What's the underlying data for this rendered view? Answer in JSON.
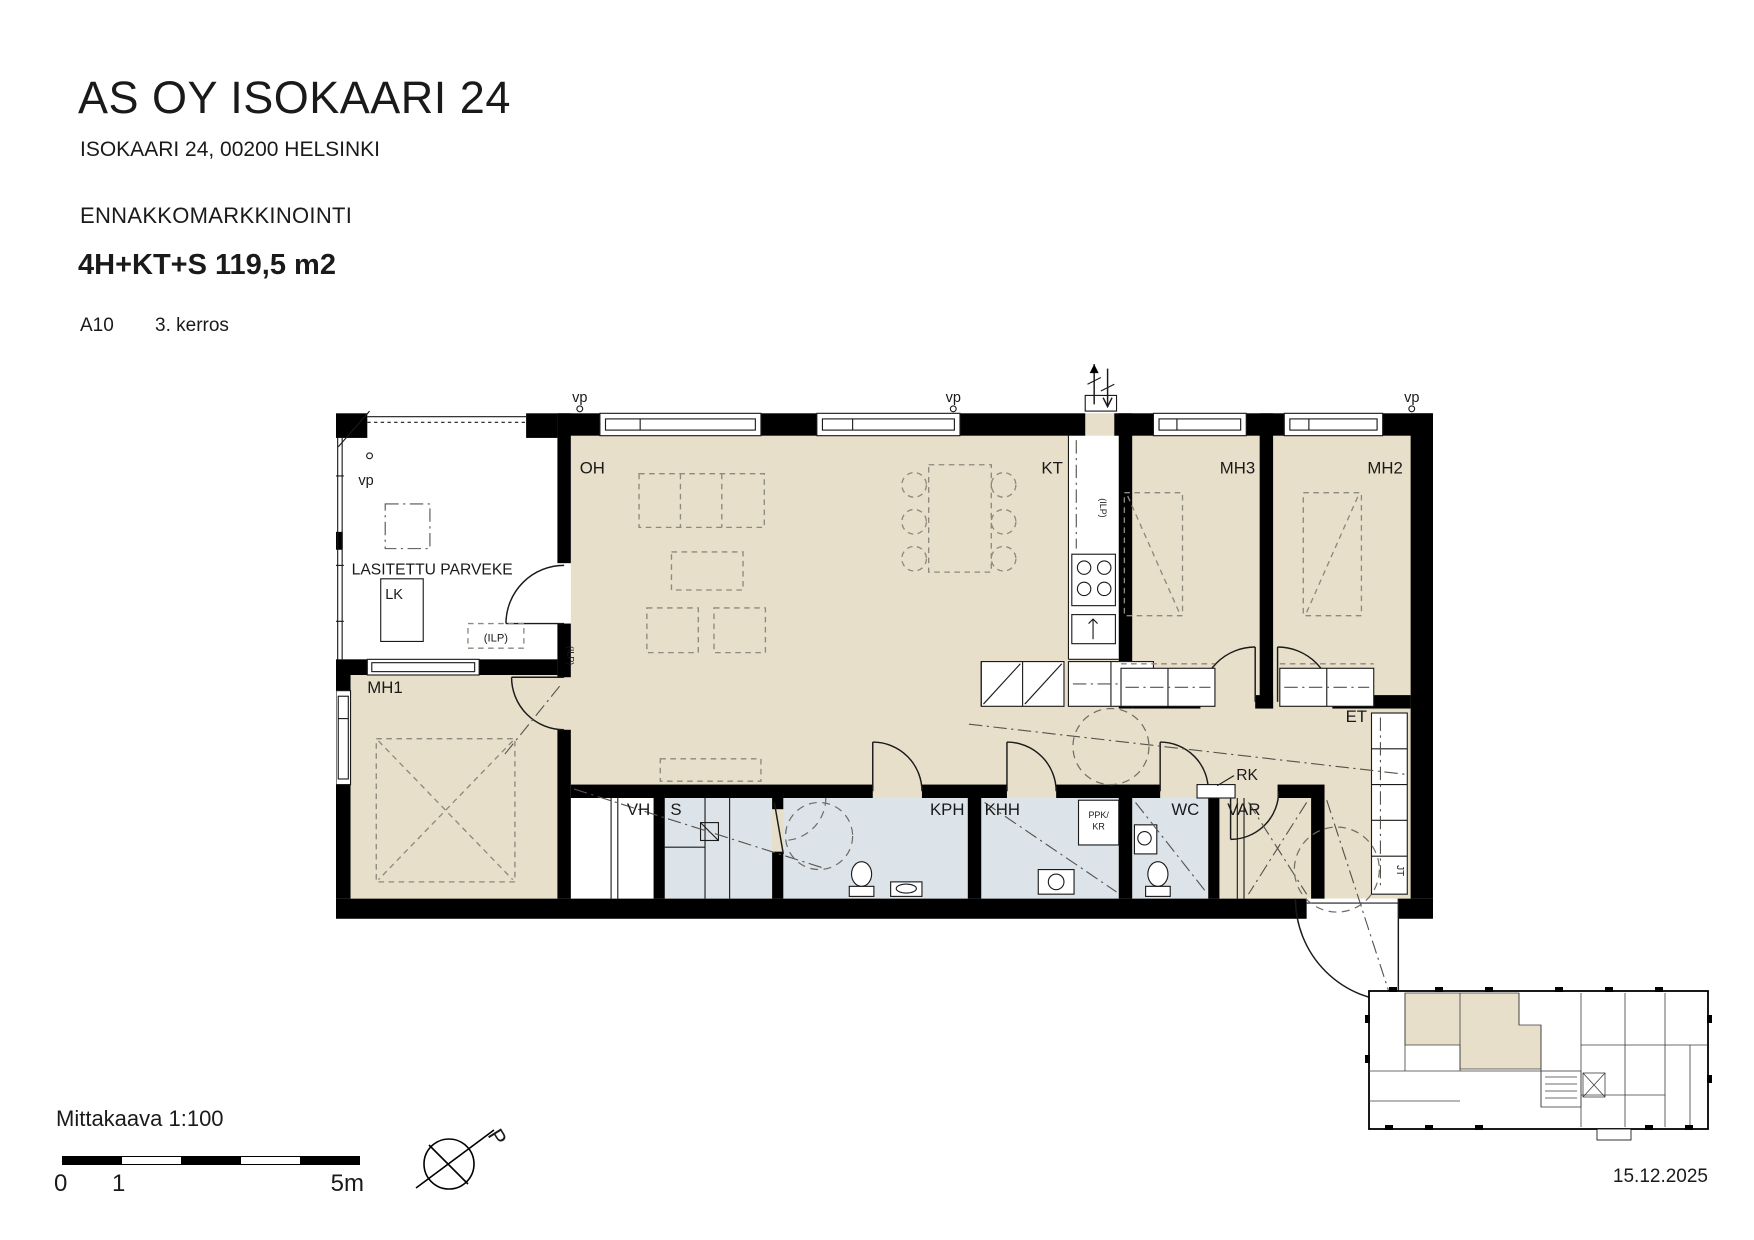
{
  "header": {
    "title": "AS OY ISOKAARI 24",
    "address": "ISOKAARI 24, 00200 HELSINKI",
    "status": "ENNAKKOMARKKINOINTI",
    "unit_type": "4H+KT+S 119,5 m2",
    "unit_id": "A10",
    "floor": "3. kerros"
  },
  "plan": {
    "labels": {
      "balcony": "LASITETTU PARVEKE",
      "lk": "LK",
      "ilp": "(ILP)",
      "vp": "vp",
      "oh": "OH",
      "kt": "KT",
      "mh1": "MH1",
      "mh2": "MH2",
      "mh3": "MH3",
      "vh": "VH",
      "s": "S",
      "kph": "KPH",
      "khh": "KHH",
      "wc": "WC",
      "var": "VAR",
      "et": "ET",
      "rk": "RK",
      "jt": "JT",
      "ppk": "PPK/",
      "kr": "KR"
    },
    "colors": {
      "floor": "#e7dfca",
      "wet": "#dde4e9",
      "wall": "#000000"
    }
  },
  "footer": {
    "scale_label": "Mittakaava 1:100",
    "scale_ticks": [
      "0",
      "1",
      "5m"
    ],
    "north_label": "P",
    "date": "15.12.2025"
  }
}
